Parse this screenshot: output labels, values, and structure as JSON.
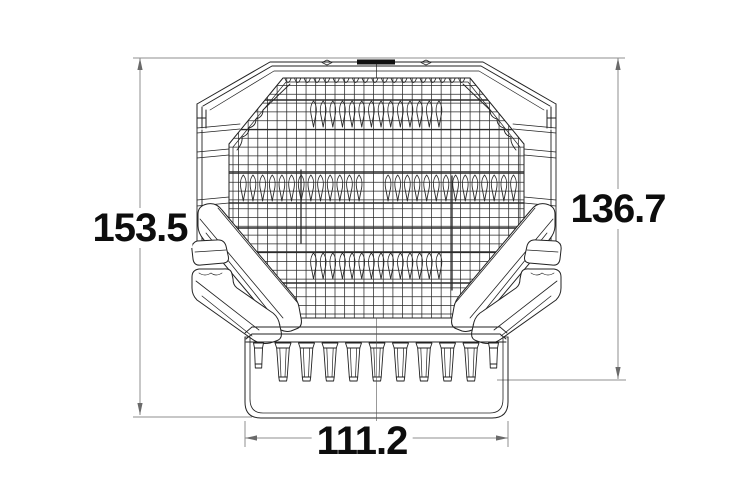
{
  "drawing": {
    "kind": "technical-dimension-drawing",
    "dimensions": {
      "overall_height": {
        "label": "153.5",
        "side": "left",
        "orientation": "vertical"
      },
      "body_height": {
        "label": "136.7",
        "side": "right",
        "orientation": "vertical"
      },
      "base_width": {
        "label": "111.2",
        "side": "bottom",
        "orientation": "horizontal"
      }
    },
    "colors": {
      "outline": "#222222",
      "dimension_line": "#8f8f8f",
      "arrow": "#6a6a6a",
      "label_text": "#0d0d0d",
      "background": "#ffffff"
    }
  }
}
